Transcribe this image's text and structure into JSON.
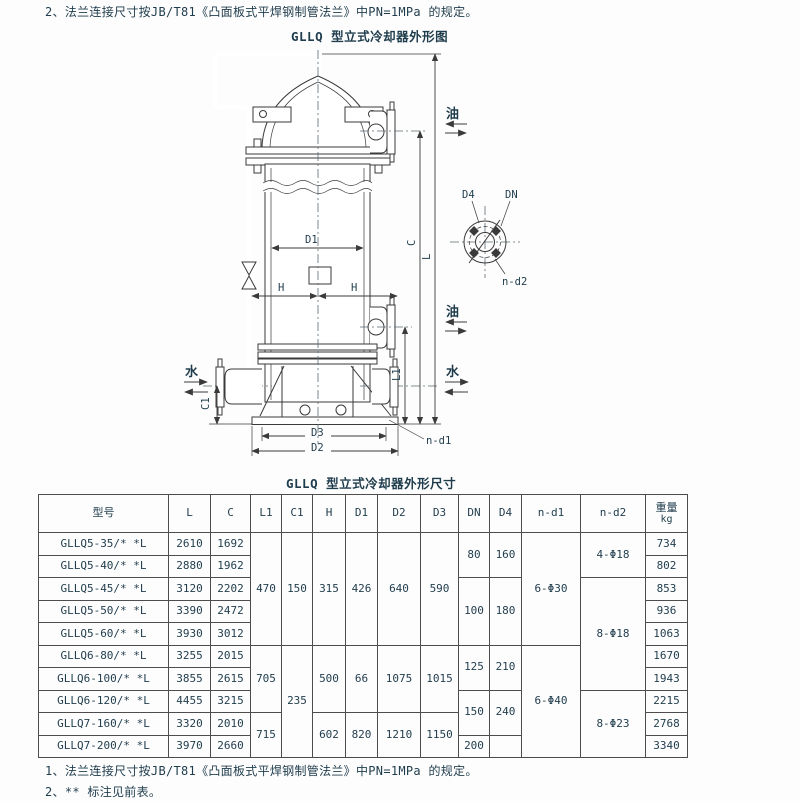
{
  "page": {
    "top_note": "2、法兰连接尺寸按JB/T81《凸面板式平焊钢制管法兰》中PN=1MPa 的规定。",
    "drawing_title": "GLLQ 型立式冷却器外形图",
    "table_title": "GLLQ 型立式冷却器外形尺寸",
    "footnote_1": "1、法兰连接尺寸按JB/T81《凸面板式平焊钢制管法兰》中PN=1MPa 的规定。",
    "footnote_2": "2、** 标注见前表。"
  },
  "drawing": {
    "labels": {
      "oil": "油",
      "water": "水",
      "d1": "D1",
      "h": "H",
      "c": "C",
      "l": "L",
      "l1": "L1",
      "c1": "C1",
      "d2": "D2",
      "d3": "D3",
      "n_d1": "n-d1",
      "d4": "D4",
      "dn": "DN",
      "n_d2": "n-d2"
    }
  },
  "table": {
    "headers": [
      "型号",
      "L",
      "C",
      "L1",
      "C1",
      "H",
      "D1",
      "D2",
      "D3",
      "DN",
      "D4",
      "n-d1",
      "n-d2",
      "重量"
    ],
    "weight_unit": "kg",
    "body": [
      {
        "cells": [
          {
            "t": "GLLQ5-35/* *L"
          },
          {
            "t": "2610"
          },
          {
            "t": "1692"
          },
          {
            "t": "470",
            "rs": 5
          },
          {
            "t": "150",
            "rs": 5
          },
          {
            "t": "315",
            "rs": 5
          },
          {
            "t": "426",
            "rs": 5
          },
          {
            "t": "640",
            "rs": 5
          },
          {
            "t": "590",
            "rs": 5
          },
          {
            "t": "80",
            "rs": 2
          },
          {
            "t": "160",
            "rs": 2
          },
          {
            "t": "6-Φ30",
            "rs": 5
          },
          {
            "t": "4-Φ18",
            "rs": 2
          },
          {
            "t": "734"
          }
        ]
      },
      {
        "cells": [
          {
            "t": "GLLQ5-40/* *L"
          },
          {
            "t": "2880"
          },
          {
            "t": "1962"
          },
          {
            "t": "802"
          }
        ]
      },
      {
        "cells": [
          {
            "t": "GLLQ5-45/* *L"
          },
          {
            "t": "3120"
          },
          {
            "t": "2202"
          },
          {
            "t": "100",
            "rs": 3
          },
          {
            "t": "180",
            "rs": 3
          },
          {
            "t": "8-Φ18",
            "rs": 5
          },
          {
            "t": "853"
          }
        ]
      },
      {
        "cells": [
          {
            "t": "GLLQ5-50/* *L"
          },
          {
            "t": "3390"
          },
          {
            "t": "2472"
          },
          {
            "t": "936"
          }
        ]
      },
      {
        "cells": [
          {
            "t": "GLLQ5-60/* *L"
          },
          {
            "t": "3930"
          },
          {
            "t": "3012"
          },
          {
            "t": "1063"
          }
        ]
      },
      {
        "cells": [
          {
            "t": "GLLQ6-80/* *L"
          },
          {
            "t": "3255"
          },
          {
            "t": "2015"
          },
          {
            "t": "705",
            "rs": 3
          },
          {
            "t": "235",
            "rs": 5
          },
          {
            "t": "500",
            "rs": 3
          },
          {
            "t": "66",
            "rs": 3
          },
          {
            "t": "1075",
            "rs": 3
          },
          {
            "t": "1015",
            "rs": 3
          },
          {
            "t": "125",
            "rs": 2
          },
          {
            "t": "210",
            "rs": 2
          },
          {
            "t": "6-Φ40",
            "rs": 5
          },
          {
            "t": "1670"
          }
        ]
      },
      {
        "cells": [
          {
            "t": "GLLQ6-100/* *L"
          },
          {
            "t": "3855"
          },
          {
            "t": "2615"
          },
          {
            "t": "1943"
          }
        ]
      },
      {
        "cells": [
          {
            "t": "GLLQ6-120/* *L"
          },
          {
            "t": "4455"
          },
          {
            "t": "3215"
          },
          {
            "t": "150",
            "rs": 2
          },
          {
            "t": "240",
            "rs": 2
          },
          {
            "t": "8-Φ23",
            "rs": 3
          },
          {
            "t": "2215"
          }
        ]
      },
      {
        "cells": [
          {
            "t": "GLLQ7-160/* *L"
          },
          {
            "t": "3320"
          },
          {
            "t": "2010"
          },
          {
            "t": "715",
            "rs": 2
          },
          {
            "t": "602",
            "rs": 2
          },
          {
            "t": "820",
            "rs": 2
          },
          {
            "t": "1210",
            "rs": 2
          },
          {
            "t": "1150",
            "rs": 2
          },
          {
            "t": "2768"
          }
        ]
      },
      {
        "cells": [
          {
            "t": "GLLQ7-200/* *L"
          },
          {
            "t": "3970"
          },
          {
            "t": "2660"
          },
          {
            "t": "200"
          },
          {
            "t": ""
          },
          {
            "t": "3340"
          }
        ]
      }
    ]
  }
}
